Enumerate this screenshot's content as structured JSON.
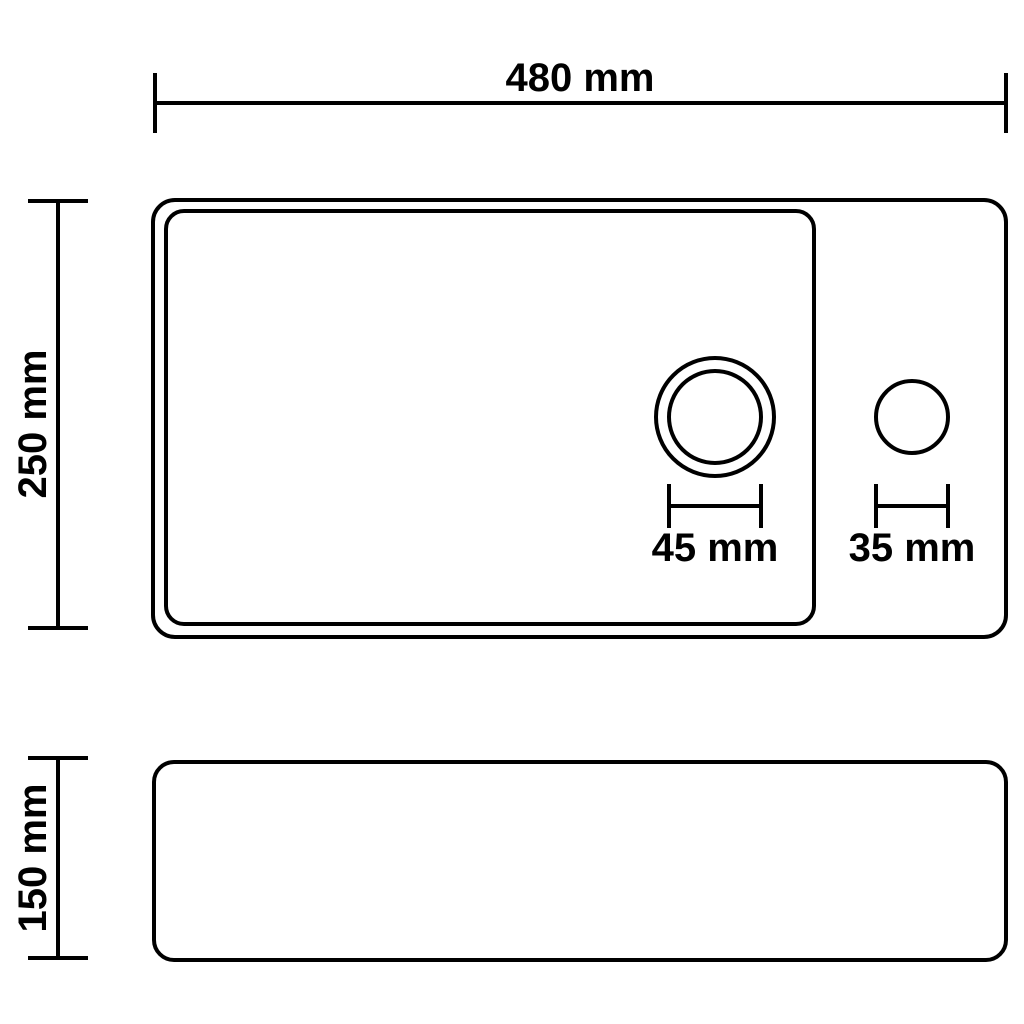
{
  "views": {
    "top_view": {
      "width_label": "480 mm",
      "width_mm": 480,
      "depth_label": "250 mm",
      "depth_mm": 250,
      "drain_hole": {
        "diameter_label": "45 mm",
        "diameter_mm": 45
      },
      "faucet_hole": {
        "diameter_label": "35 mm",
        "diameter_mm": 35
      }
    },
    "side_view": {
      "height_label": "150 mm",
      "height_mm": 150
    }
  },
  "colors": {
    "line": "#000000",
    "text": "#000000",
    "background": "#ffffff"
  }
}
